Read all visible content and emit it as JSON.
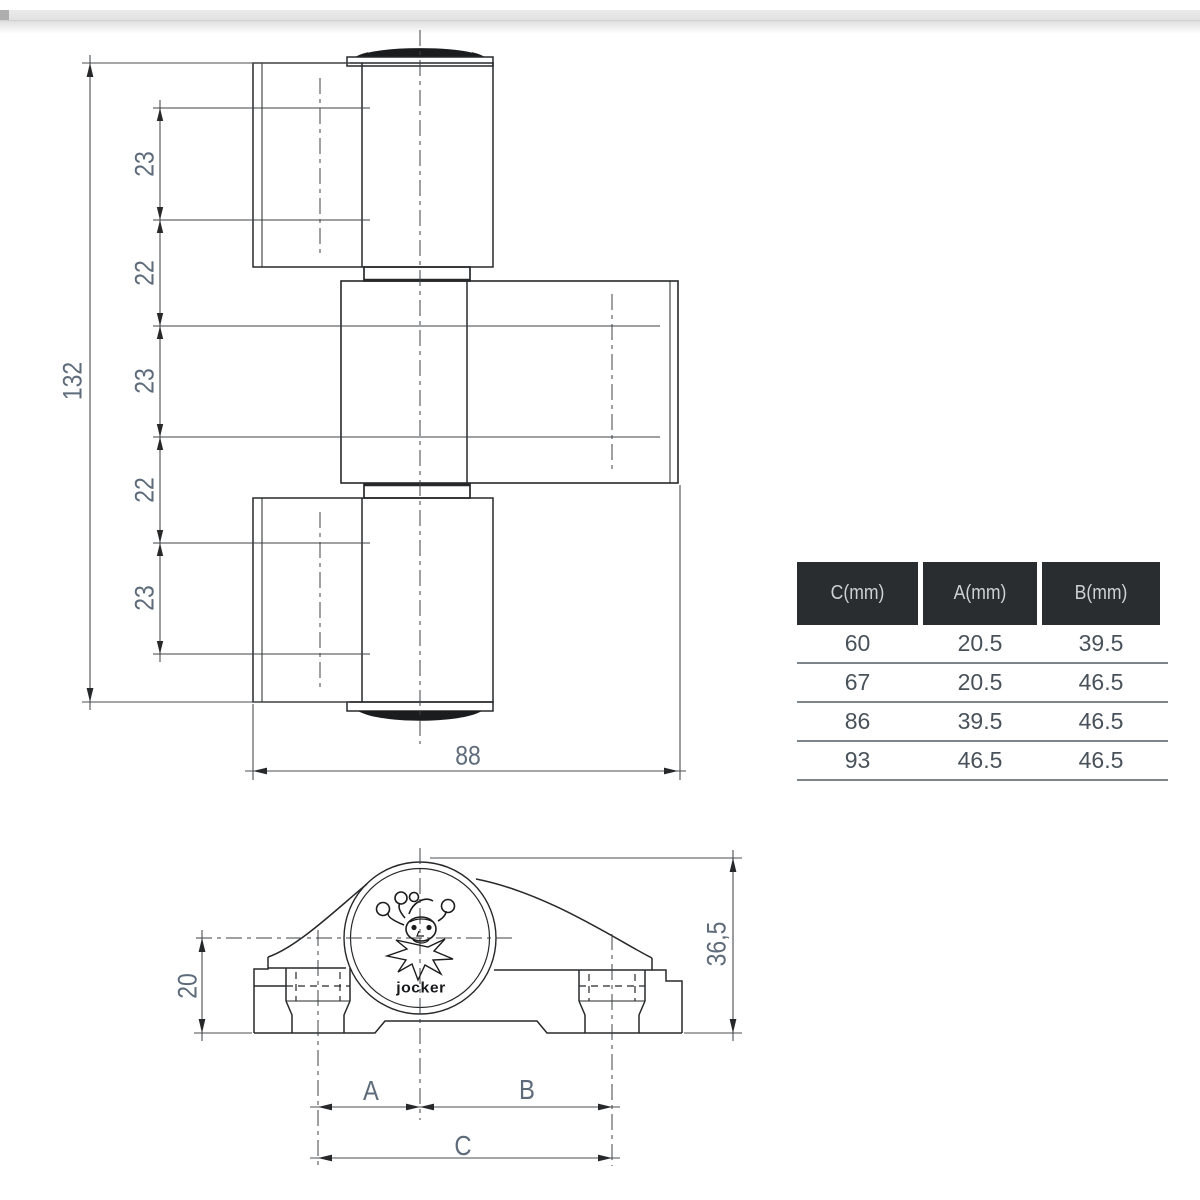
{
  "theme": {
    "line_color": "#26282a",
    "centerline_color": "#3c4043",
    "dim_line_color": "#4a4d50",
    "dim_text_color": "#5e6b7a",
    "logo_color": "#17181a",
    "header_bg": "#2a2d2f",
    "header_text": "#ccd1d5",
    "row_text": "#49525a",
    "separator": "#7d848a"
  },
  "front_view": {
    "description": "hinge front elevation",
    "dims": {
      "overall_height": "132",
      "overall_width": "88",
      "chain": [
        "23",
        "22",
        "23",
        "22",
        "23"
      ]
    }
  },
  "bottom_view": {
    "description": "hinge top profile",
    "dims": {
      "base_height": "20",
      "total_height": "36,5",
      "a_label": "A",
      "b_label": "B",
      "c_label": "C"
    },
    "logo_text": "jocker"
  },
  "table": {
    "headers": [
      "C(mm)",
      "A(mm)",
      "B(mm)"
    ],
    "rows": [
      [
        "60",
        "20.5",
        "39.5"
      ],
      [
        "67",
        "20.5",
        "46.5"
      ],
      [
        "86",
        "39.5",
        "46.5"
      ],
      [
        "93",
        "46.5",
        "46.5"
      ]
    ]
  }
}
